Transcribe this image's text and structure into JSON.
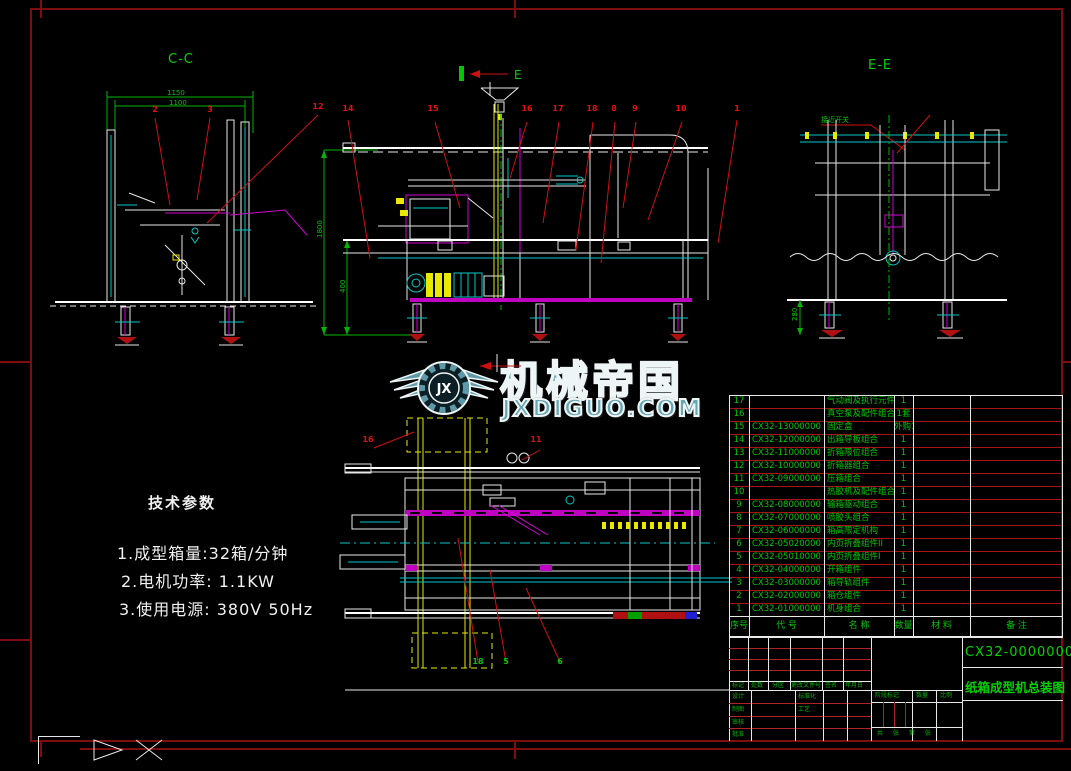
{
  "colors": {
    "sheet_frame": "#7e0d0d",
    "table_grid_red": "#a81414",
    "annotation_green": "#00c800",
    "callout_red": "#e01010",
    "watermark_teal": "#67a6b4"
  },
  "labels": {
    "section_left": "C-C",
    "section_right": "E-E",
    "section_arrow": "E",
    "proximity_switch": "接近开关"
  },
  "watermark": {
    "monogram": "JX",
    "brand": "机械帝国",
    "site": "JXDIGUO.COM"
  },
  "tech_params": {
    "title": "技术参数",
    "items": [
      "1.成型箱量:32箱/分钟",
      "2.电机功率: 1.1KW",
      "3.使用电源: 380V 50Hz"
    ]
  },
  "dimensions": {
    "view_cc": [
      "1150",
      "1100"
    ],
    "view_main": [
      "1800",
      "400"
    ],
    "view_ee": [
      "280"
    ]
  },
  "callouts": {
    "main": [
      "14",
      "15",
      "16",
      "17",
      "18",
      "8",
      "9",
      "10",
      "1"
    ],
    "cc": [
      "2",
      "3",
      "12"
    ],
    "plan": [
      "16",
      "11"
    ],
    "plan_bottom": [
      "18",
      "5",
      "6"
    ]
  },
  "bom": {
    "headers": [
      "序号",
      "代  号",
      "名  称",
      "数量",
      "材  料",
      "备  注"
    ],
    "rows": [
      [
        "17",
        "",
        "气动阀及执行元件组合装置",
        "1"
      ],
      [
        "16",
        "",
        "真空泵及配件组合",
        "1套"
      ],
      [
        "15",
        "CX32-13000000",
        "固定盒",
        "外购1"
      ],
      [
        "14",
        "CX32-12000000",
        "出箱导板组合",
        "1"
      ],
      [
        "13",
        "CX32-11000000",
        "折箱限位组合",
        "1"
      ],
      [
        "12",
        "CX32-10000000",
        "折箱器组合",
        "1"
      ],
      [
        "11",
        "CX32-09000000",
        "压箱组合",
        "1"
      ],
      [
        "10",
        "",
        "热胶机及配件组合",
        "1"
      ],
      [
        "9",
        "CX32-08000000",
        "输箱驱动组合",
        "1"
      ],
      [
        "8",
        "CX32-07000000",
        "喷胶头组合",
        "1"
      ],
      [
        "7",
        "CX32-06000000",
        "箱高限定机构",
        "1"
      ],
      [
        "6",
        "CX32-05020000",
        "内页折叠组件II",
        "1"
      ],
      [
        "5",
        "CX32-05010000",
        "内页折叠组件I",
        "1"
      ],
      [
        "4",
        "CX32-04000000",
        "开箱组件",
        "1"
      ],
      [
        "3",
        "CX32-03000000",
        "箱导轨组件",
        "1"
      ],
      [
        "2",
        "CX32-02000000",
        "箱仓组件",
        "1"
      ],
      [
        "1",
        "CX32-01000000",
        "机身组合",
        "1"
      ]
    ]
  },
  "title_block": {
    "drawing_no": "CX32-00000000",
    "drawing_title": "纸箱成型机总装图",
    "revision_headers": [
      "标记",
      "处数",
      "分区",
      "更改文件号",
      "签名",
      "年月日"
    ],
    "left_labels": [
      "设计",
      "制图",
      "审核",
      "批准"
    ],
    "mid_labels": [
      "标准化",
      "工艺"
    ],
    "stage_header": "阶段标记",
    "qty_header": "数量",
    "scale_header": "比例",
    "sheet_note": "共 张 第 张"
  }
}
